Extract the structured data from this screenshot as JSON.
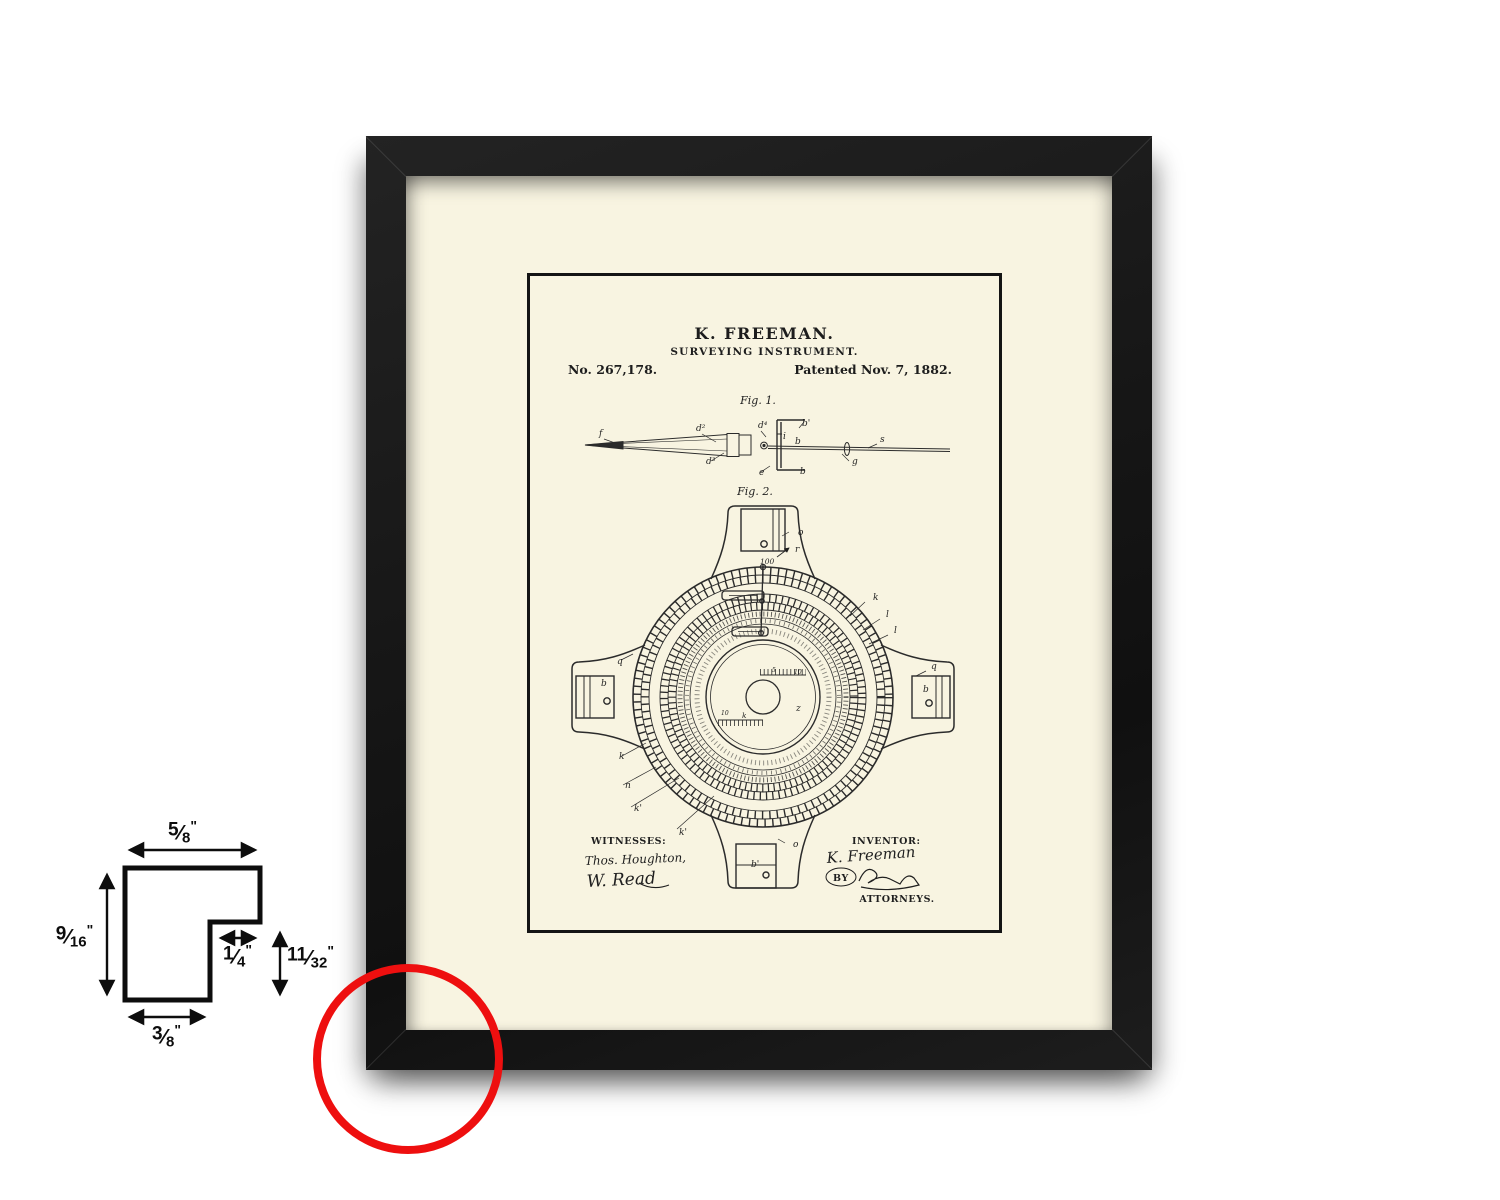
{
  "colors": {
    "frame": "#1a1a1a",
    "mat": "#f8f4e1",
    "highlight": "#ee0f0f",
    "ink": "#1f1f1f"
  },
  "patent": {
    "inventor_name": "K. FREEMAN.",
    "doc_title": "SURVEYING INSTRUMENT.",
    "patent_number": "No. 267,178.",
    "patent_date": "Patented Nov. 7, 1882.",
    "fig1_label": "Fig. 1.",
    "fig2_label": "Fig. 2.",
    "witnesses_heading": "WITNESSES:",
    "witness_1": "Thos. Houghton,",
    "witness_2": "W. Read",
    "inventor_heading": "INVENTOR:",
    "inventor_signature": "K. Freeman",
    "by_label": "BY",
    "attorneys_label": "ATTORNEYS.",
    "fig1_annotations": [
      {
        "t": "f",
        "x": 72,
        "y": 163
      },
      {
        "t": "d²",
        "x": 169,
        "y": 158
      },
      {
        "t": "d³",
        "x": 179,
        "y": 191
      },
      {
        "t": "d⁴",
        "x": 231,
        "y": 155
      },
      {
        "t": "b'",
        "x": 275,
        "y": 153
      },
      {
        "t": "i",
        "x": 256,
        "y": 166
      },
      {
        "t": "b",
        "x": 268,
        "y": 171
      },
      {
        "t": "b",
        "x": 273,
        "y": 201
      },
      {
        "t": "e",
        "x": 232,
        "y": 202
      },
      {
        "t": "g",
        "x": 325,
        "y": 191
      },
      {
        "t": "s",
        "x": 353,
        "y": 169
      }
    ],
    "fig2_annotations": [
      {
        "t": "100",
        "x": 233,
        "y": 291,
        "s": 7.5
      },
      {
        "t": "r",
        "x": 268,
        "y": 279
      },
      {
        "t": "o",
        "x": 271,
        "y": 262
      },
      {
        "t": "k",
        "x": 346,
        "y": 327
      },
      {
        "t": "l",
        "x": 359,
        "y": 344
      },
      {
        "t": "l",
        "x": 367,
        "y": 360
      },
      {
        "t": "q",
        "x": 404,
        "y": 396
      },
      {
        "t": "b",
        "x": 396,
        "y": 419
      },
      {
        "t": "q",
        "x": 90,
        "y": 391
      },
      {
        "t": "b",
        "x": 74,
        "y": 413
      },
      {
        "t": "k",
        "x": 92,
        "y": 486
      },
      {
        "t": "n",
        "x": 98,
        "y": 515
      },
      {
        "t": "k'",
        "x": 107,
        "y": 538
      },
      {
        "t": "k'",
        "x": 152,
        "y": 562
      },
      {
        "t": "o",
        "x": 266,
        "y": 574
      },
      {
        "t": "b'",
        "x": 224,
        "y": 594
      },
      {
        "t": "z",
        "x": 269,
        "y": 438
      },
      {
        "t": "k",
        "x": 215,
        "y": 445,
        "s": 7.5
      },
      {
        "t": "10",
        "x": 194,
        "y": 442,
        "s": 6
      },
      {
        "t": "5",
        "x": 245,
        "y": 399,
        "s": 6
      },
      {
        "t": "10",
        "x": 267,
        "y": 401,
        "s": 6
      }
    ]
  },
  "dimension_diagram": {
    "top": {
      "num": "5",
      "den": "8",
      "unit": "\""
    },
    "left": {
      "num": "9",
      "den": "16",
      "unit": "\""
    },
    "notch": {
      "num": "1",
      "den": "4",
      "unit": "\""
    },
    "right": {
      "num": "11",
      "den": "32",
      "unit": "\""
    },
    "bottom": {
      "num": "3",
      "den": "8",
      "unit": "\""
    }
  }
}
